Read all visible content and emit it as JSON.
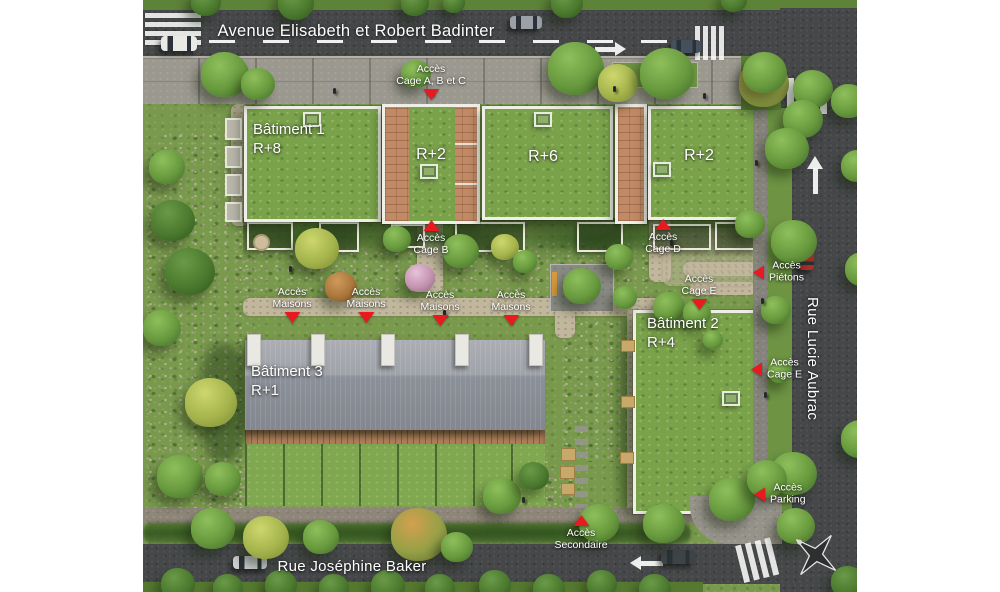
{
  "streets": {
    "avenue": "Avenue Elisabeth et Robert Badinter",
    "rue_right": "Rue Lucie Aubrac",
    "rue_bottom": "Rue Joséphine Baker"
  },
  "buildings": {
    "b1": {
      "name": "Bâtiment 1",
      "floors": "R+8"
    },
    "block_r2_mid": {
      "floors": "R+2"
    },
    "block_r6": {
      "floors": "R+6"
    },
    "block_r2_right": {
      "floors": "R+2"
    },
    "b2": {
      "name": "Bâtiment 2",
      "floors": "R+4"
    },
    "b3": {
      "name": "Bâtiment 3",
      "floors": "R+1"
    }
  },
  "access_markers": [
    {
      "label": "Accès Cage A, B et C",
      "lines": [
        "Accès",
        "Cage A, B et C"
      ],
      "dir": "down",
      "x": 288,
      "y": 64
    },
    {
      "label": "Accès Cage B",
      "lines": [
        "Accès",
        "Cage B"
      ],
      "dir": "up",
      "x": 288,
      "y": 220
    },
    {
      "label": "Accès Cage D",
      "lines": [
        "Accès",
        "Cage D"
      ],
      "dir": "up",
      "x": 520,
      "y": 219
    },
    {
      "label": "Accès Cage E",
      "lines": [
        "Accès",
        "Cage E"
      ],
      "dir": "down",
      "x": 556,
      "y": 274
    },
    {
      "label": "Accès Maisons",
      "lines": [
        "Accès",
        "Maisons"
      ],
      "dir": "down",
      "x": 149,
      "y": 287
    },
    {
      "label": "Accès Maisons",
      "lines": [
        "Accès",
        "Maisons"
      ],
      "dir": "down",
      "x": 223,
      "y": 287
    },
    {
      "label": "Accès Maisons",
      "lines": [
        "Accès",
        "Maisons"
      ],
      "dir": "down",
      "x": 297,
      "y": 290
    },
    {
      "label": "Accès Maisons",
      "lines": [
        "Accès",
        "Maisons"
      ],
      "dir": "down",
      "x": 368,
      "y": 290
    },
    {
      "label": "Accès Piétons",
      "lines": [
        "Accès",
        "Piétons"
      ],
      "dir": "left",
      "x": 610,
      "y": 272
    },
    {
      "label": "Accès Cage E",
      "lines": [
        "Accès",
        "Cage E"
      ],
      "dir": "left",
      "x": 608,
      "y": 369
    },
    {
      "label": "Accès Parking",
      "lines": [
        "Accès",
        "Parking"
      ],
      "dir": "left",
      "x": 611,
      "y": 494
    },
    {
      "label": "Accès Secondaire",
      "lines": [
        "Accès",
        "Secondaire"
      ],
      "dir": "up",
      "x": 438,
      "y": 515
    }
  ],
  "colors": {
    "marker_red": "#e81a20",
    "label_text": "#ffffff"
  }
}
